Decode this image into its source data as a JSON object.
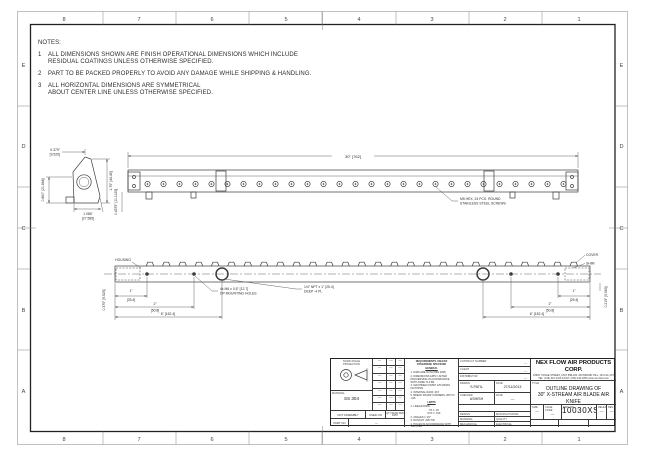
{
  "sheet": {
    "zones": {
      "cols": [
        "8",
        "7",
        "6",
        "5",
        "4",
        "3",
        "2",
        "1"
      ],
      "rows": [
        "E",
        "D",
        "C",
        "B",
        "A"
      ]
    }
  },
  "notes": {
    "title": "NOTES:",
    "items": [
      {
        "num": "1",
        "line1": "ALL DIMENSIONS SHOWN ARE FINISH OPERATIONAL DIMENSIONS WHICH INCLUDE",
        "line2": "RESIDUAL COATINGS UNLESS OTHERWISE SPECIFIED."
      },
      {
        "num": "2",
        "line1": "PART TO BE PACKED PROPERLY TO AVOID ANY DAMAGE WHILE SHIPPING & HANDLING.",
        "line2": ""
      },
      {
        "num": "3",
        "line1": "ALL HORIZONTAL DIMENSIONS ARE SYMMETRICAL",
        "line2": "ABOUT CENTER LINE UNLESS OTHERWISE SPECIFIED."
      }
    ]
  },
  "top_view": {
    "dim_overall": "30\" [762]",
    "dim_left": "0.4375\" [11.1125]",
    "screw_callout_1": "M5 HEX, 24 PCS. ROUND",
    "screw_callout_2": "STAINLESS STEEL SCREWS"
  },
  "section_view": {
    "dim_top_in": "0.375\"",
    "dim_top_mm": "[9.525]",
    "dim_right": "1.75\" [44.45]",
    "dim_bottom_in": "1.086\"",
    "dim_bottom_mm": "[27.585]",
    "dim_left": "0.860\" [21.844]"
  },
  "bottom_view": {
    "label_housing": "HOUSING",
    "label_cover": "COVER",
    "label_shim": "SHIM",
    "dim_1_in": "1\"",
    "dim_1_mm": "[25.4]",
    "dim_2_in": "2\"",
    "dim_2_mm": "[50.8]",
    "dim_6": "6\" [152.4]",
    "dim_left_v": "0.375\" [9.525]",
    "dim_right_v": "0.219\" [5.563]",
    "callout_m6_1": "4x M6 x 0.5\" [12.7]",
    "callout_m6_2": "DP MOUNTING HOLES",
    "callout_npt_1": "1/4\" NPT x 1\" [25.4]",
    "callout_npt_2": "DEEP  -4 PL"
  },
  "title_block": {
    "dash": "—",
    "projection": {
      "line1": "THIRD ANGLE",
      "line2": "PROJECTION"
    },
    "material": {
      "label": "MATERIAL",
      "value": "SS 304"
    },
    "bottom": {
      "not_assembly": "NOT ASSEMBLY",
      "used_on": "USED ON",
      "qty": "QTY REQD PER ASSY",
      "part_no_label": "PART NO",
      "part_no_value": "—"
    },
    "requirements": {
      "header1": "REQUIREMENTS UNLESS",
      "header2": "OTHERWISE SPECIFIED",
      "general_label": "GENERAL",
      "g1": "1. DIMS ARE IN INCHES (MM)",
      "g2": "2. DIMENSIONS APPLY AFTER PROCESSING IN ACCORDANCE WITH ASME Y14.5M",
      "g3": "3. MACHINED FINISH 125 MICRO INCH RMS",
      "g4": "4. INTERNAL RADII .015",
      "g5": "5. BREAK SHARP CORNERS .005 TO .015",
      "limits_label": "LIMITS",
      "l1": "1. LINEAR DIMS:",
      "l1a": ".XX ± .03",
      "l1b": ".XXX ± .010",
      "l2": "2. ANGLES ± 1/2°",
      "l3": "3. RUNOUT .005 TIR",
      "l4": "4. HOLES IN ACCORDANCE WITH ANSI STD"
    },
    "admin": {
      "contract_label": "CONTRACT NUMBER",
      "contract_value": "—",
      "client_label": "CLIENT",
      "client_value": "—",
      "distributor_label": "DISTRIBUTOR",
      "distributor_value": "—",
      "drawn_label": "DRAWN",
      "drawn_value": "S.PATIL",
      "date_label": "DATE",
      "date_value": "27/11/2013",
      "checked_label": "CHECKED",
      "checked_value": "ASHISH",
      "date2_label": "DATE",
      "date2_value": "—",
      "project_label": "PROJECT",
      "project_value": "N.A.",
      "design_label": "DESIGN",
      "manufacturing_label": "MANUFACTURING",
      "material_label": "MATERIAL",
      "quality_label": "QUALITY",
      "mechanical_label": "MECHANICAL",
      "electrical_label": "ELECTRICAL"
    },
    "company": {
      "name": "NEX FLOW AIR PRODUCTS CORP.",
      "address": "10520 YONGE STREET, UNIT 35B-220, RICHMOND HILL, ON L4C 3C7",
      "tel": "TEL: (416) 410-1313 & FAX: (416) 410-1806  www.nex-flow.com"
    },
    "title": {
      "label": "TITLE",
      "line1": "OUTLINE DRAWING OF",
      "line2": "30\" X-STREAM AIR BLADE AIR KNIFE"
    },
    "ids": {
      "size_label": "SIZE",
      "size_value": "—",
      "cage_label": "CAGE CODE",
      "cage_value": "—",
      "dwg_label": "DWG NO",
      "dwg_value": "10030XS",
      "release_label": "RELEASE",
      "release_value": "—",
      "rev_label": "REV",
      "rev_value": "—"
    },
    "footer": {
      "scale_label": "SCALE",
      "scale_value": "1:1",
      "cad_label": "CAD NO",
      "cad_value": "6AKS-30",
      "sheet_label": "SHEET",
      "sheet_value": "1 OF 1"
    }
  }
}
